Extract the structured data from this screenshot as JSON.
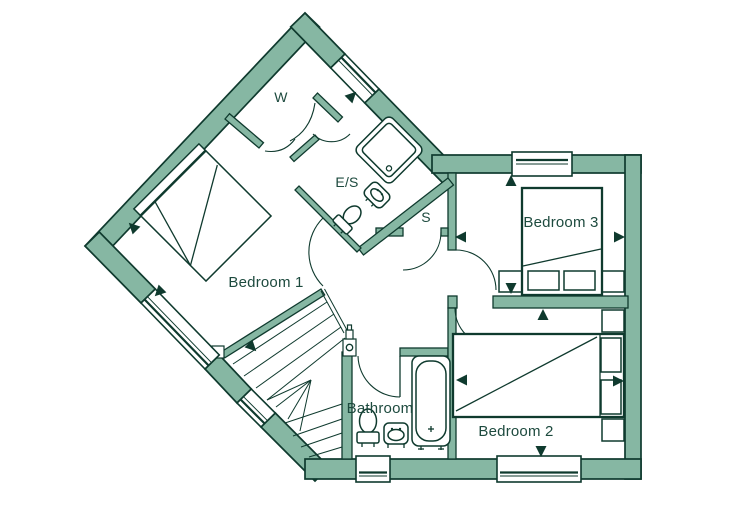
{
  "floorplan": {
    "colors": {
      "wall": "#86b7a3",
      "line": "#0f3a2e",
      "text": "#1d4a3e",
      "floor": "#ffffff"
    },
    "rooms": {
      "bedroom1": {
        "label": "Bedroom 1"
      },
      "bedroom2": {
        "label": "Bedroom 2"
      },
      "bedroom3": {
        "label": "Bedroom 3"
      },
      "bathroom": {
        "label": "Bathroom"
      },
      "ensuite": {
        "label": "E/S"
      },
      "wardrobe": {
        "label": "W"
      },
      "store": {
        "label": "S"
      }
    }
  }
}
